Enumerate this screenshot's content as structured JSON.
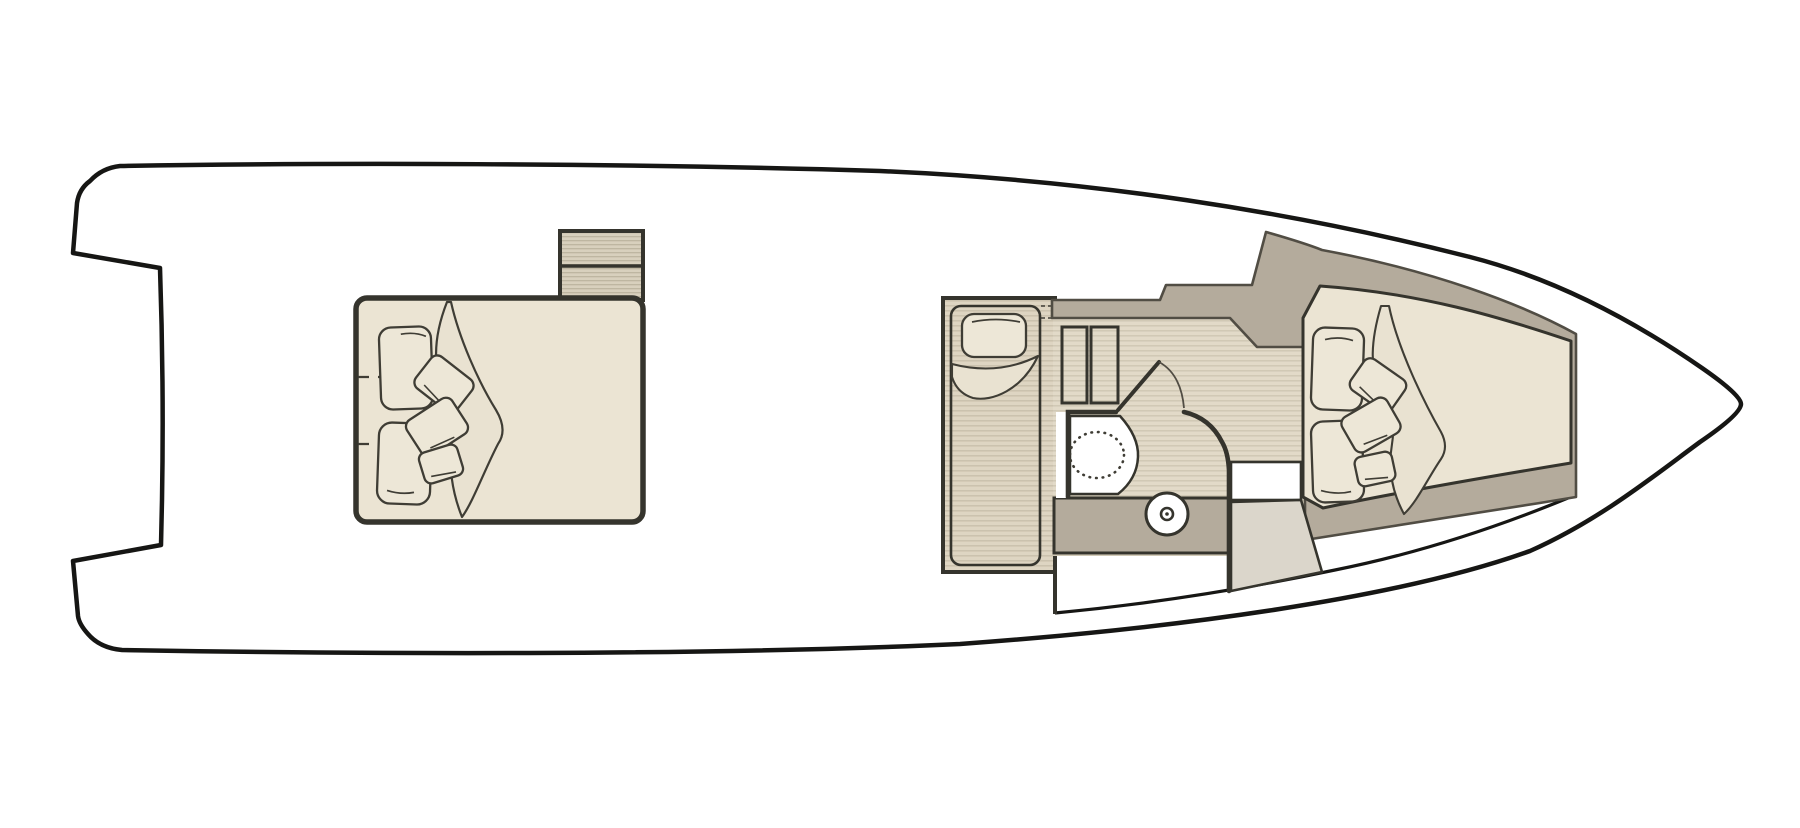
{
  "title": "Motor yacht lower-deck floor plan (top view)",
  "diagram": {
    "type": "boat-floor-plan",
    "orientation": "bow-right-stern-left",
    "rooms": [
      {
        "name": "aft-cabin",
        "features": [
          "double-bed",
          "two-pillows",
          "three-throw-cushions",
          "blanket-drape",
          "mattress-split-dashed-lines",
          "companionway-steps"
        ]
      },
      {
        "name": "midship-side-berth",
        "features": [
          "single-berth",
          "pillow",
          "folded-blanket",
          "plank-floor"
        ]
      },
      {
        "name": "head-compartment",
        "features": [
          "wardrobe-two-doors",
          "hinged-door-with-swing-arc",
          "shower-tray",
          "toilet-dashed-outline",
          "vanity-counter",
          "round-washbasin"
        ]
      },
      {
        "name": "bow-cabin",
        "features": [
          "v-berth-double-bed",
          "two-pillows",
          "three-throw-cushions",
          "blanket-drape",
          "tapered-trunk-walls"
        ]
      }
    ]
  },
  "colors": {
    "page_bg": "#ffffff",
    "hull_fill": "#ffffff",
    "hull_outline": "#161614",
    "wall_dark": "#35342d",
    "soft_outline": "#514d44",
    "taupe_wall": "#b4ab9c",
    "bed_fill": "#ebe4d3",
    "pillow_fill": "#ede7d7",
    "blanket_fill": "#e9e2d1",
    "floor_base": "#e2dac8",
    "floor_line": "#cfc7b3",
    "berth_floor_base": "#ded5c2",
    "berth_floor_line": "#c9c0ab",
    "steps_base": "#d8d0bd",
    "steps_line": "#bcb39e",
    "landing_fill": "#dbd6cb",
    "white": "#ffffff",
    "dash_line": "#3f3d35"
  }
}
